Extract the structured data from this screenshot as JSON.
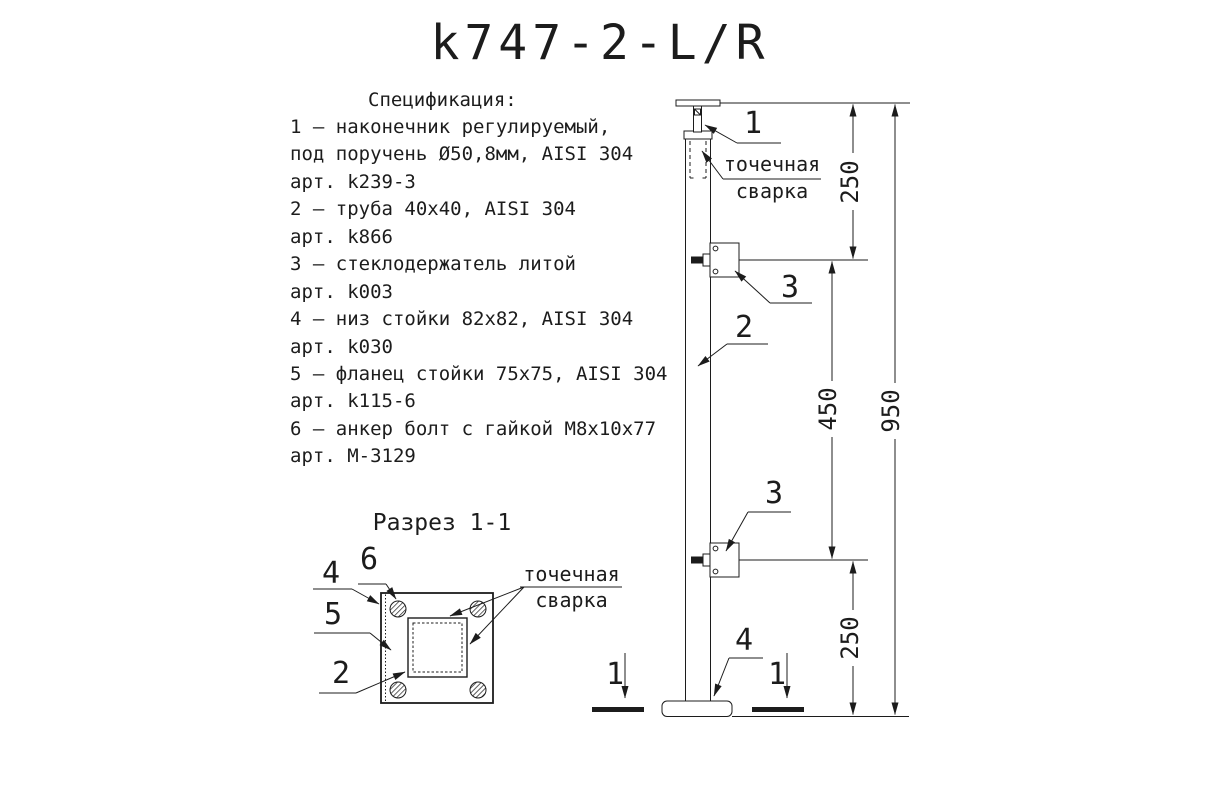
{
  "colors": {
    "line": "#1c1c1c",
    "background": "#ffffff"
  },
  "title": "k747-2-L/R",
  "spec": {
    "heading": "Спецификация:",
    "lines": [
      "1 – наконечник регулируемый,",
      "под поручень Ø50,8мм, AISI 304",
      "арт. k239-3",
      "2 – труба 40x40, AISI 304",
      "арт. k866",
      "3 – стеклодержатель литой",
      "арт. k003",
      "4 – низ стойки 82x82, AISI 304",
      "арт. k030",
      "5 – фланец стойки 75x75, AISI 304",
      "арт. k115-6",
      "6 – анкер болт с гайкой M8x10x77",
      "арт. M-3129"
    ]
  },
  "cross_section": {
    "title": "Разрез 1-1",
    "callouts": {
      "plate": "4",
      "anchor": "6",
      "flange": "5",
      "tube": "2"
    },
    "weld_note": {
      "line1": "точечная",
      "line2": "сварка"
    }
  },
  "elevation": {
    "callouts": {
      "tip": "1",
      "tube": "2",
      "glass_holder_top": "3",
      "glass_holder_bottom": "3",
      "base": "4"
    },
    "weld_note": {
      "line1": "точечная",
      "line2": "сварка"
    },
    "dimensions": {
      "top": "250",
      "middle": "450",
      "bottom": "250",
      "overall": "950"
    },
    "section_markers": {
      "left": "1",
      "right": "1"
    }
  }
}
